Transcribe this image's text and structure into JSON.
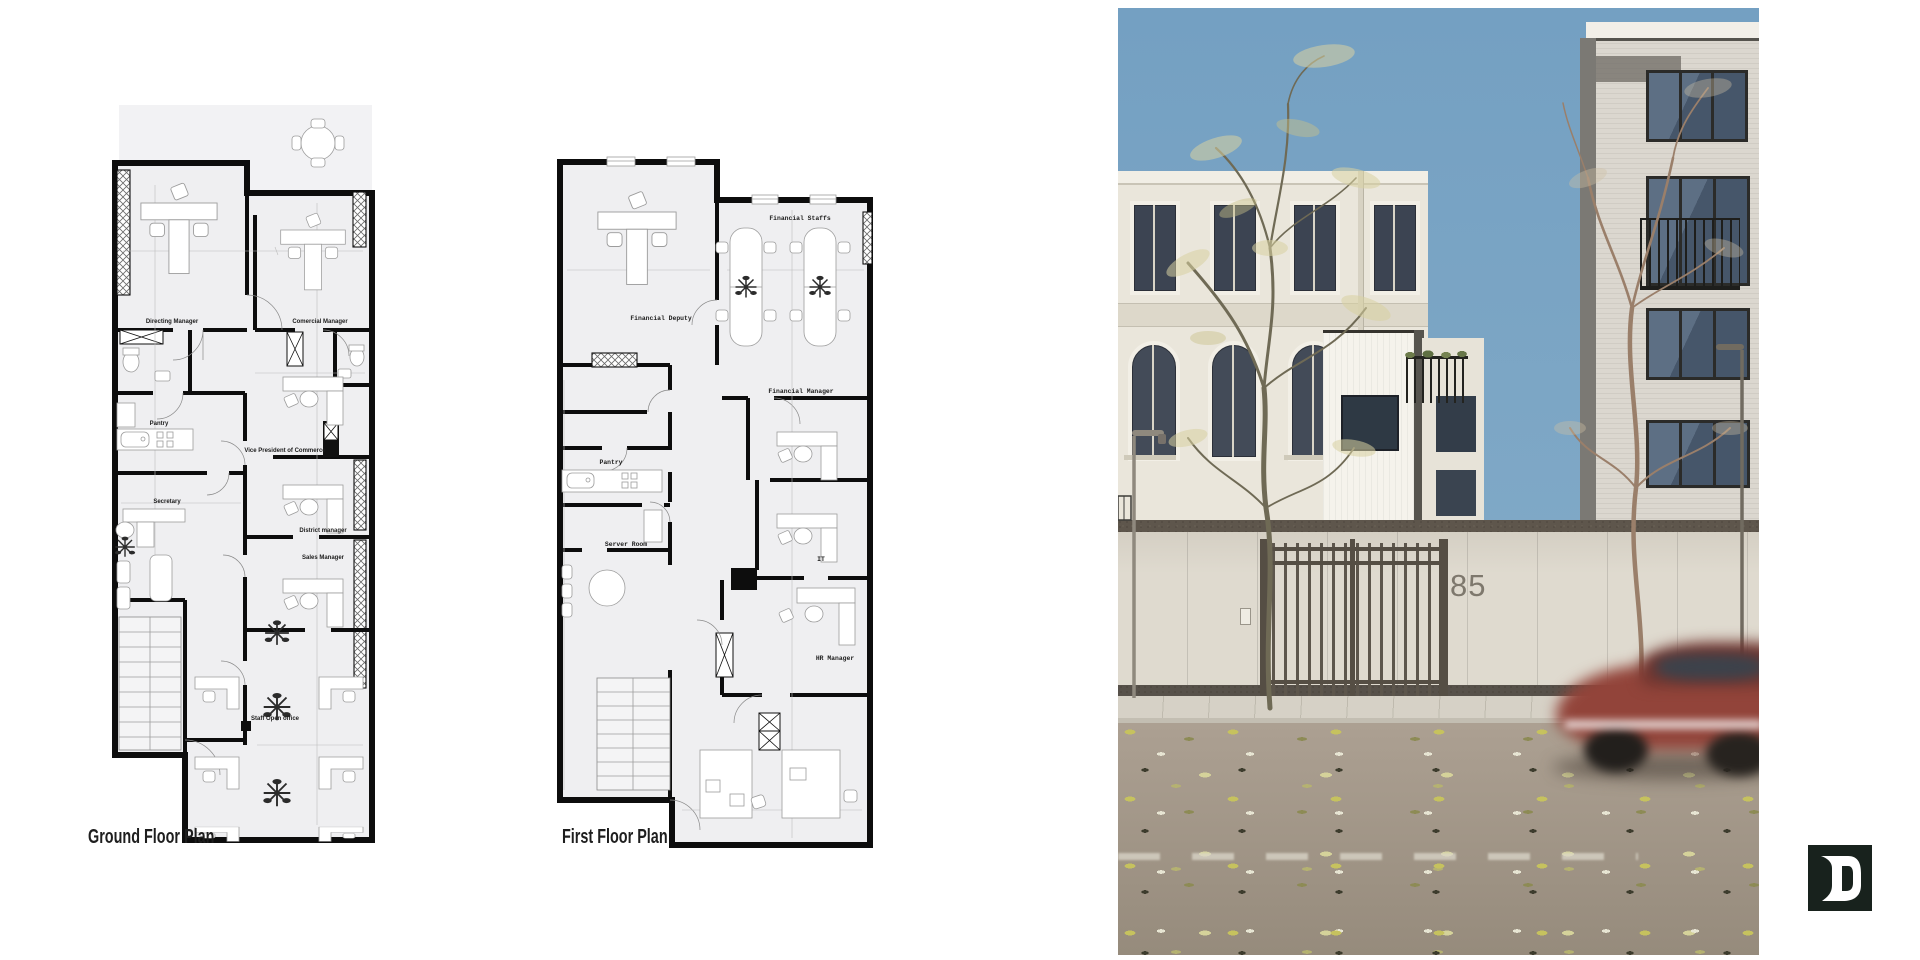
{
  "page": {
    "background": "#ffffff"
  },
  "plans": {
    "ground": {
      "caption": "Ground Floor Plan",
      "rooms": {
        "directing_manager": "Directing Manager",
        "comercial_manager": "Comercial Manager",
        "pantry": "Pantry",
        "secretary": "Secretary",
        "vice_president": "Vice President of Commerce",
        "district_manager": "District manager",
        "sales_manager": "Sales Manager",
        "staff_open_office": "Staff Open office"
      }
    },
    "first": {
      "caption": "First Floor Plan",
      "rooms": {
        "financial_staffs": "Financial Staffs",
        "financial_deputy": "Financial Deputy",
        "financial_manager": "Financial Manager",
        "pantry": "Pantry",
        "server_room": "Server Room",
        "it": "IT",
        "hr_manager": "HR Manager"
      }
    }
  },
  "photo": {
    "house_number": "85",
    "colors": {
      "sky": "#7aa3c4",
      "facade_cream": "#eae6db",
      "facade_brick": "#dbd7cf",
      "front_wall": "#dfdacf",
      "road": "#a89c8f",
      "car_red": "#92443a",
      "leaf_green": "#c6c25e"
    }
  },
  "logo": {
    "letter": "D",
    "background": "#18221d"
  }
}
